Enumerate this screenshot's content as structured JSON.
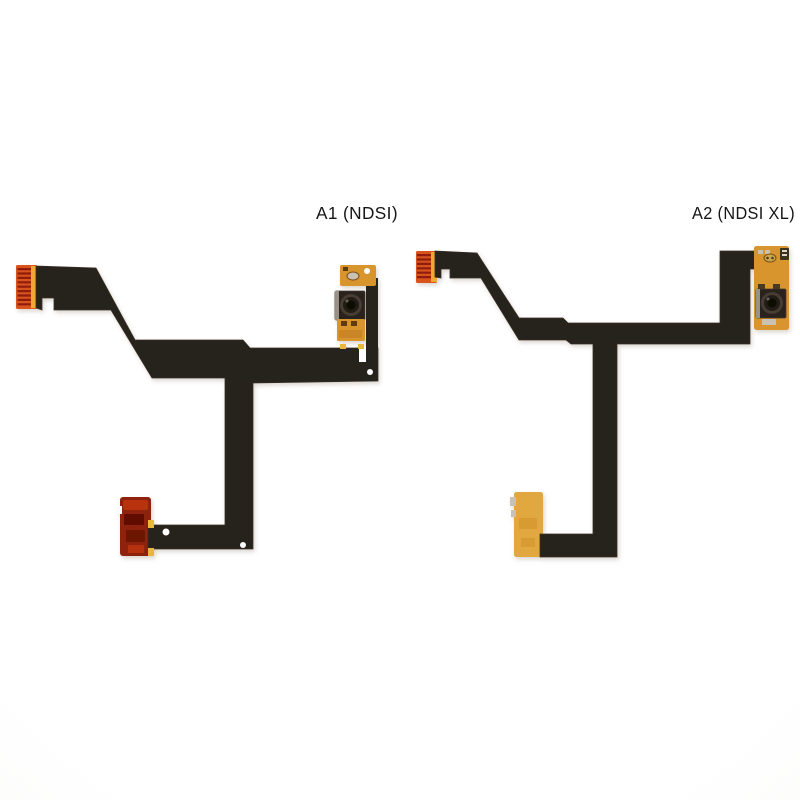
{
  "scene": {
    "kind": "product-photo",
    "background": "#fdfdfd"
  },
  "items": [
    {
      "id": "A1",
      "caption": "A1 (NDSI)",
      "parts": [
        "pin-connector",
        "flex-ribbon",
        "gold-contact-pad",
        "camera-module",
        "camera-flex-pad",
        "red-flex-end"
      ]
    },
    {
      "id": "A2",
      "caption": "A2 (NDSI XL)",
      "parts": [
        "pin-connector",
        "flex-ribbon",
        "gold-camera-strip",
        "camera-module",
        "gold-flex-end"
      ]
    }
  ],
  "colors": {
    "cable": "#27201a",
    "cable_edge": "#3a2f26",
    "connector_orange": "#d9521e",
    "connector_pin_stripe": "#8f1f0e",
    "connector_amber_bar": "#f2a733",
    "gold_flex": "#d8952e",
    "gold_flex_light": "#e2a83f",
    "gold_border": "#b57a1e",
    "gold_dark_mark": "#5e3a10",
    "red_flex": "#8e2009",
    "red_flex_dark": "#550d02",
    "red_flex_light": "#c03513",
    "camera_body": "#2a231d",
    "camera_metal_edge": "#9a9287",
    "lens_ring": "#463c31",
    "lens_mid": "#241d16",
    "lens_center": "#0a0705",
    "silver_component": "#c9c2b4",
    "solder_tab": "#e8b83a",
    "hole": "#fdfdfd",
    "label_text": "#151515"
  }
}
